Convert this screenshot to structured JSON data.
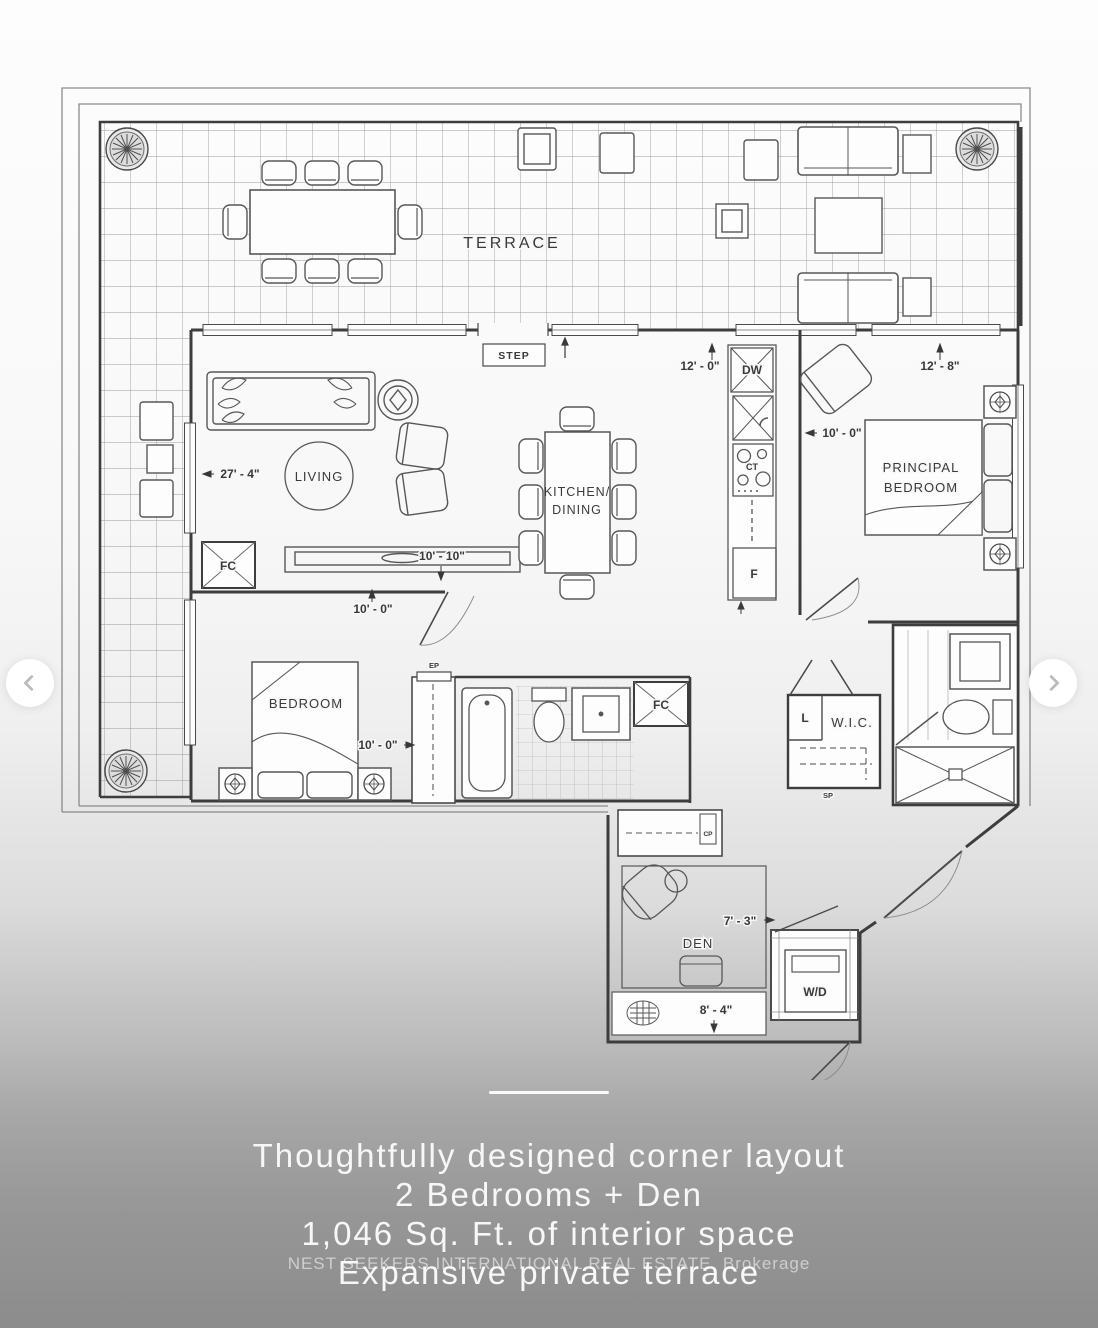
{
  "colors": {
    "ink": "#3d3d3d",
    "background_top": "#fdfdfd",
    "background_bottom": "#8c8c8c",
    "caption_text": "#f7f7f7",
    "arrow_icon": "#b9bcbe",
    "arrow_bg": "#ffffff"
  },
  "carousel": {
    "prev": "chevron-left",
    "next": "chevron-right"
  },
  "plan": {
    "terrace_label": "TERRACE",
    "step_label": "STEP",
    "rooms": {
      "living": "LIVING",
      "kitchen_dining_line1": "KITCHEN/",
      "kitchen_dining_line2": "DINING",
      "principal_line1": "PRINCIPAL",
      "principal_line2": "BEDROOM",
      "bedroom": "BEDROOM",
      "den": "DEN",
      "wic": "W.I.C."
    },
    "features": {
      "dw": "DW",
      "ct": "CT",
      "fridge": "F",
      "fan_coil": "FC",
      "wd": "W/D",
      "linen": "L",
      "ep": "EP",
      "sp": "SP",
      "cp": "CP"
    },
    "dimensions": {
      "living_width": "27' - 4\"",
      "kitchen_window": "12' - 0\"",
      "principal_window": "12' - 8\"",
      "principal_depth": "10' - 0\"",
      "kitchen_run": "10' - 10\"",
      "living_run": "10' - 0\"",
      "bedroom_width": "10' - 0\"",
      "den_depth": "7' - 3\"",
      "den_width": "8' - 4\""
    }
  },
  "caption": {
    "line1": "Thoughtfully designed corner layout",
    "line2": "2 Bedrooms + Den",
    "line3": "1,046 Sq. Ft. of interior space",
    "line4": "Expansive private terrace"
  },
  "watermark": "NEST SEEKERS INTERNATIONAL REAL ESTATE, Brokerage"
}
